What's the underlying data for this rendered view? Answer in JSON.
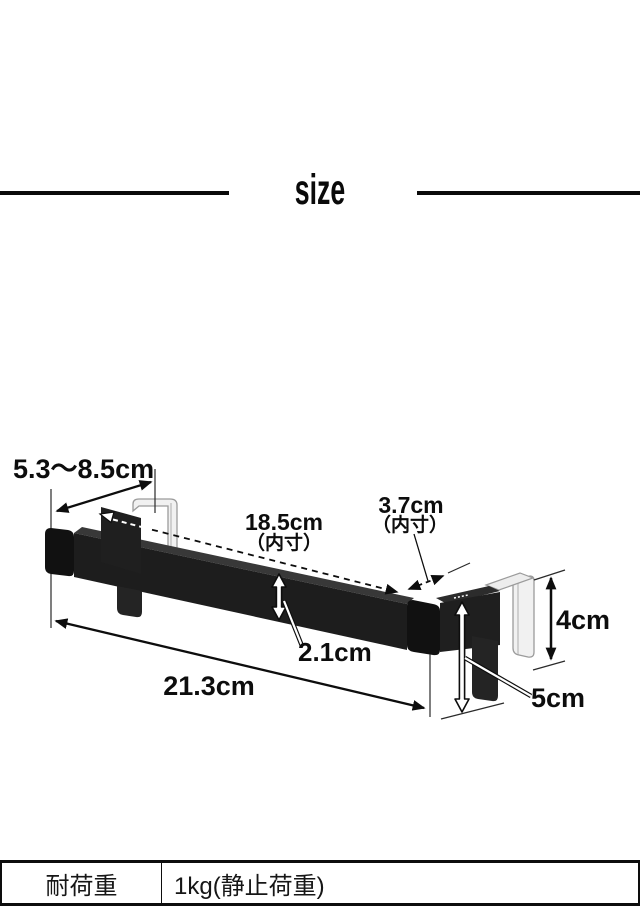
{
  "header": {
    "title": "size"
  },
  "diagram": {
    "labels": {
      "hook_depth": {
        "text": "5.3～8.5cm"
      },
      "inner_width": {
        "text": "18.5cm",
        "note": "（内寸）"
      },
      "inner_depth": {
        "text": "3.7cm",
        "note": "（内寸）"
      },
      "bar_thickness": {
        "text": "2.1cm"
      },
      "overall_width": {
        "text": "21.3cm"
      },
      "hook_height": {
        "text": "4cm"
      },
      "bracket_drop": {
        "text": "5cm"
      }
    },
    "colors": {
      "product_black": "#1d1d1d",
      "product_top": "#383838",
      "cap_black": "#111111",
      "bracket_black": "#1f1f1f",
      "tab_black": "#242424",
      "hook_gray": "#f1f1f1",
      "hook_outline": "#9b9b9b",
      "line": "#0f0f0f"
    }
  },
  "spec_table": {
    "rows": [
      {
        "label": "耐荷重",
        "value": "1kg(静止荷重)"
      }
    ]
  }
}
